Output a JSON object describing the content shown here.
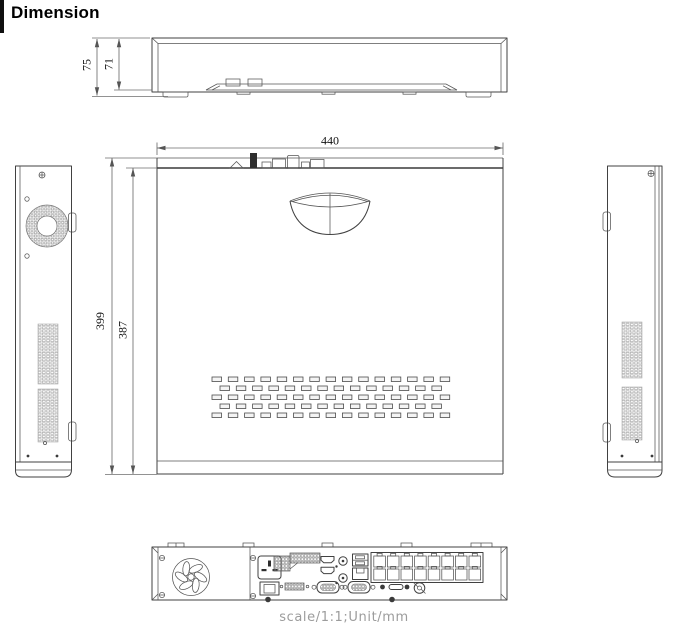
{
  "page": {
    "title": "Dimension",
    "scale_note": "scale/1:1;Unit/mm"
  },
  "dims": {
    "front_total_height": "75",
    "front_body_height": "71",
    "top_width": "440",
    "top_total_depth": "399",
    "top_body_depth": "387"
  },
  "colors": {
    "accent_bar": "#101010",
    "drawing_line": "#414141",
    "dimension_line": "#6e6e6e",
    "note_text": "#9c9c9c",
    "background": "#ffffff"
  }
}
